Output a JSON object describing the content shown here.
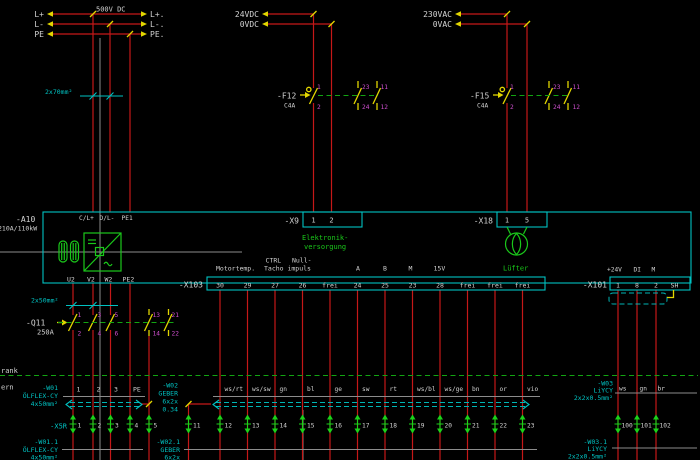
{
  "top": {
    "dc": {
      "voltage": "500V DC",
      "left": [
        "L+",
        "L-",
        "PE"
      ],
      "right": [
        "L+.",
        "L-.",
        "PE."
      ]
    },
    "v24": [
      "24VDC",
      "0VDC"
    ],
    "v230": [
      "230VAC",
      "0VAC"
    ],
    "marker70": "2x70mm²"
  },
  "f12": {
    "name": "-F12",
    "rating": "C4A",
    "main": [
      "1",
      "2"
    ],
    "aux1": [
      "23",
      "24"
    ],
    "aux2": [
      "11",
      "12"
    ]
  },
  "f15": {
    "name": "-F15",
    "rating": "C4A",
    "main": [
      "1",
      "2"
    ],
    "aux1": [
      "23",
      "24"
    ],
    "aux2": [
      "11",
      "12"
    ]
  },
  "a10": {
    "name": "-A10",
    "rating": "210A/110kW",
    "top_terminals": [
      "C/L+",
      "D/L-",
      "PE1"
    ],
    "bottom_terminals": [
      "U2",
      "V2",
      "W2",
      "PE2"
    ]
  },
  "x9": {
    "name": "-X9",
    "terminals": [
      "1",
      "2"
    ],
    "caption": [
      "Elektronik-",
      "versorgung"
    ]
  },
  "x18": {
    "name": "-X18",
    "terminals": [
      "1",
      "5"
    ],
    "caption": "Lüfter"
  },
  "signals": {
    "ctrl": "CTRL",
    "null": "Null-",
    "motortemp": "Motortemp.",
    "tacho": "Tacho impuls",
    "a": "A",
    "b": "B",
    "m": "M",
    "v15": "15V",
    "plus24": "+24V",
    "di": "DI",
    "m2": "M"
  },
  "x103": {
    "name": "-X103",
    "terminals": [
      "30",
      "29",
      "27",
      "26",
      "frei",
      "24",
      "25",
      "23",
      "28",
      "frei",
      "frei",
      "frei"
    ]
  },
  "x101": {
    "name": "-X101",
    "terminals": [
      "1",
      "8",
      "2",
      "SH"
    ]
  },
  "marker50": "2x50mm²",
  "q11": {
    "name": "-Q11",
    "rating": "250A",
    "poles": [
      [
        "1",
        "2"
      ],
      [
        "3",
        "4"
      ],
      [
        "5",
        "6"
      ]
    ],
    "aux": [
      [
        "13",
        "14"
      ],
      [
        "21",
        "22"
      ]
    ]
  },
  "boundary": {
    "label_top": "rank",
    "label_bottom": "ern"
  },
  "w01": {
    "name": "-W01",
    "type": "ÖLFLEX-CY",
    "size": "4x50mm²",
    "cores": [
      "1",
      "2",
      "3",
      "PE"
    ]
  },
  "w01_1": {
    "name": "-W01.1",
    "type": "ÖLFLEX-CY",
    "size": "4x50mm²"
  },
  "w02": {
    "name": "-W02",
    "type": "GEBER",
    "size1": "6x2x",
    "size2": "0.34",
    "cores": [
      "ws/rt",
      "ws/sw",
      "gn",
      "bl",
      "ge",
      "sw",
      "rt",
      "ws/bl",
      "ws/ge",
      "bn",
      "or",
      "vio"
    ]
  },
  "w02_1": {
    "name": "-W02.1",
    "type": "GEBER",
    "size": "6x2x"
  },
  "w03": {
    "name": "-W03",
    "type": "LiYCY",
    "size": "2x2x0.5mm²",
    "cores": [
      "ws",
      "gn",
      "br"
    ]
  },
  "w03_1": {
    "name": "-W03.1",
    "type": "LiYCY",
    "size": "2x2x0.5mm²"
  },
  "x5r": {
    "name": "-X5R",
    "terminals": [
      "1",
      "2",
      "3",
      "4",
      "5"
    ]
  },
  "bottom_terminals": [
    "11",
    "12",
    "13",
    "14",
    "15",
    "16",
    "17",
    "18",
    "19",
    "20",
    "21",
    "22",
    "23"
  ],
  "right_terminals": [
    "100",
    "101",
    "102"
  ]
}
